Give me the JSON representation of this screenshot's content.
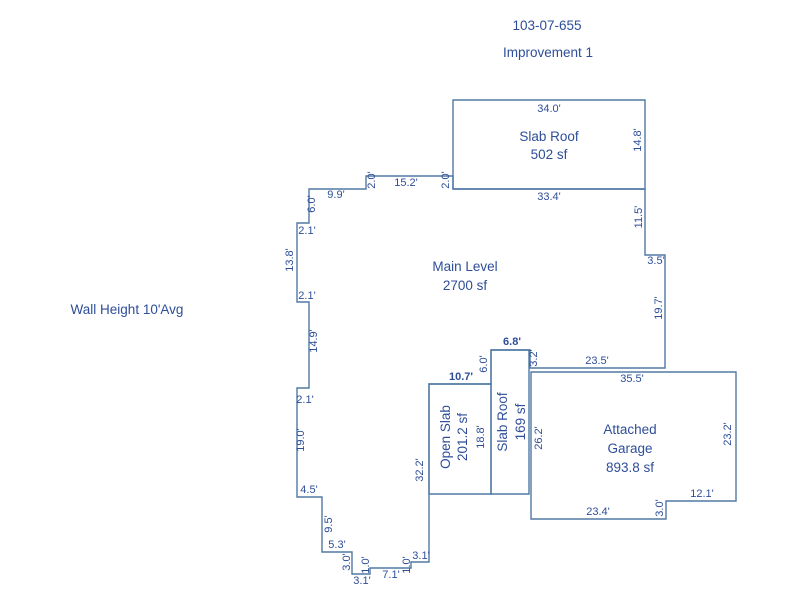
{
  "header": {
    "parcel_number": "103-07-655",
    "improvement_label": "Improvement 1"
  },
  "notes": {
    "wall_height": "Wall Height 10'Avg"
  },
  "colors": {
    "outline": "#5179a4",
    "text": "#2e4e99",
    "background": "#ffffff"
  },
  "areas": {
    "slab_roof_top": {
      "name": "Slab Roof",
      "area": "502 sf"
    },
    "main_level": {
      "name": "Main Level",
      "area": "2700 sf"
    },
    "open_slab": {
      "name": "Open Slab",
      "area": "201.2 sf"
    },
    "slab_roof_mid": {
      "name": "Slab Roof",
      "area": "169 sf"
    },
    "attached_garage": {
      "name_line1": "Attached",
      "name_line2": "Garage",
      "area": "893.8 sf"
    }
  },
  "dims": {
    "slab_top": "34.0'",
    "slab_right": "14.8'",
    "slab_bottom": "33.4'",
    "step_a": "2.0'",
    "top_mid": "15.2'",
    "step_b": "2.0'",
    "top_left": "9.9'",
    "left_a": "6.0'",
    "left_b": "2.1'",
    "left_c": "13.8'",
    "left_d": "2.1'",
    "left_e": "14.9'",
    "left_f": "2.1'",
    "left_g": "19.0'",
    "left_h": "4.5'",
    "left_i": "9.5'",
    "left_j": "5.3'",
    "left_k": "3.0'",
    "bottom_a": "3.1'",
    "bottom_b": "1.0'",
    "bottom_c": "7.1'",
    "bottom_d": "1.0'",
    "bottom_e": "3.1'",
    "open_left": "32.2'",
    "open_top": "10.7'",
    "open_right": "18.8'",
    "slabmid_left": "6.0'",
    "slabmid_top": "6.8'",
    "step_c": "3.2'",
    "main_bottom_right": "23.5'",
    "right_a": "19.7'",
    "right_b": "3.5'",
    "right_c": "11.5'",
    "garage_top": "35.5'",
    "garage_right": "23.2'",
    "garage_notch": "12.1'",
    "garage_step": "3.0'",
    "garage_bottom": "23.4'",
    "garage_left": "26.2'"
  }
}
